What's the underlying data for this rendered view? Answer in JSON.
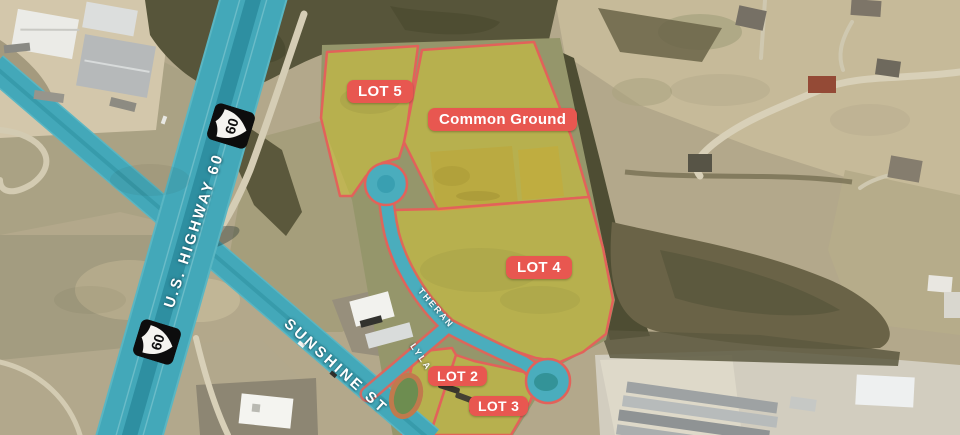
{
  "map": {
    "lot_labels": [
      {
        "id": "lot5",
        "text": "LOT 5"
      },
      {
        "id": "common_ground",
        "text": "Common Ground"
      },
      {
        "id": "lot4",
        "text": "LOT 4"
      },
      {
        "id": "lot2",
        "text": "LOT 2"
      },
      {
        "id": "lot3",
        "text": "LOT 3"
      }
    ],
    "street_labels": {
      "highway": "U.S. HIGHWAY 60",
      "sunshine": "SUNSHINE ST",
      "theran": "THERAN",
      "lyla": "LYLA"
    },
    "route_shield": {
      "number": "60"
    },
    "colors": {
      "road_highlight": "#43a8b9",
      "road_median": "#2e8fa1",
      "lot_fill": "#d9ca32",
      "boundary_line": "#e2625a",
      "label_background": "#e85750",
      "label_text": "#ffffff"
    }
  }
}
